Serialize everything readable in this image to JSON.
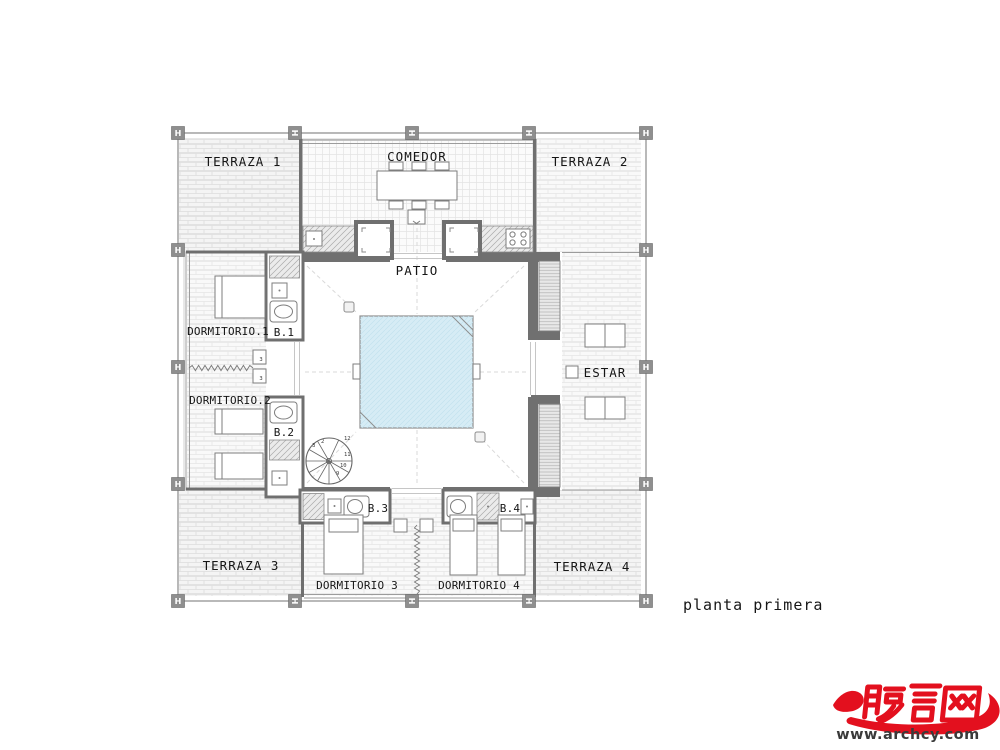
{
  "plan": {
    "title": "planta primera",
    "rooms": {
      "terraza1": "TERRAZA 1",
      "terraza2": "TERRAZA 2",
      "terraza3": "TERRAZA 3",
      "terraza4": "TERRAZA 4",
      "comedor": "COMEDOR",
      "patio": "PATIO",
      "dormitorio1": "DORMITORIO.1",
      "dormitorio2": "DORMITORIO.2",
      "dormitorio3": "DORMITORIO 3",
      "dormitorio4": "DORMITORIO 4",
      "estar": "ESTAR",
      "b1": "B.1",
      "b2": "B.2",
      "b3": "B.3",
      "b4": "B.4"
    },
    "stair": {
      "n2": "2",
      "n3": "3",
      "n9": "9",
      "n10": "10",
      "n11": "11",
      "n12": "12"
    },
    "closet_mark": "3",
    "column_marker_glyph": "H"
  },
  "watermark": {
    "logo_text": "畅言网",
    "site_url": "www.archcy.com"
  },
  "colors": {
    "pool_fill": "#d6ecf5",
    "wall": "#707070",
    "watermark_red": "#e3101e"
  }
}
